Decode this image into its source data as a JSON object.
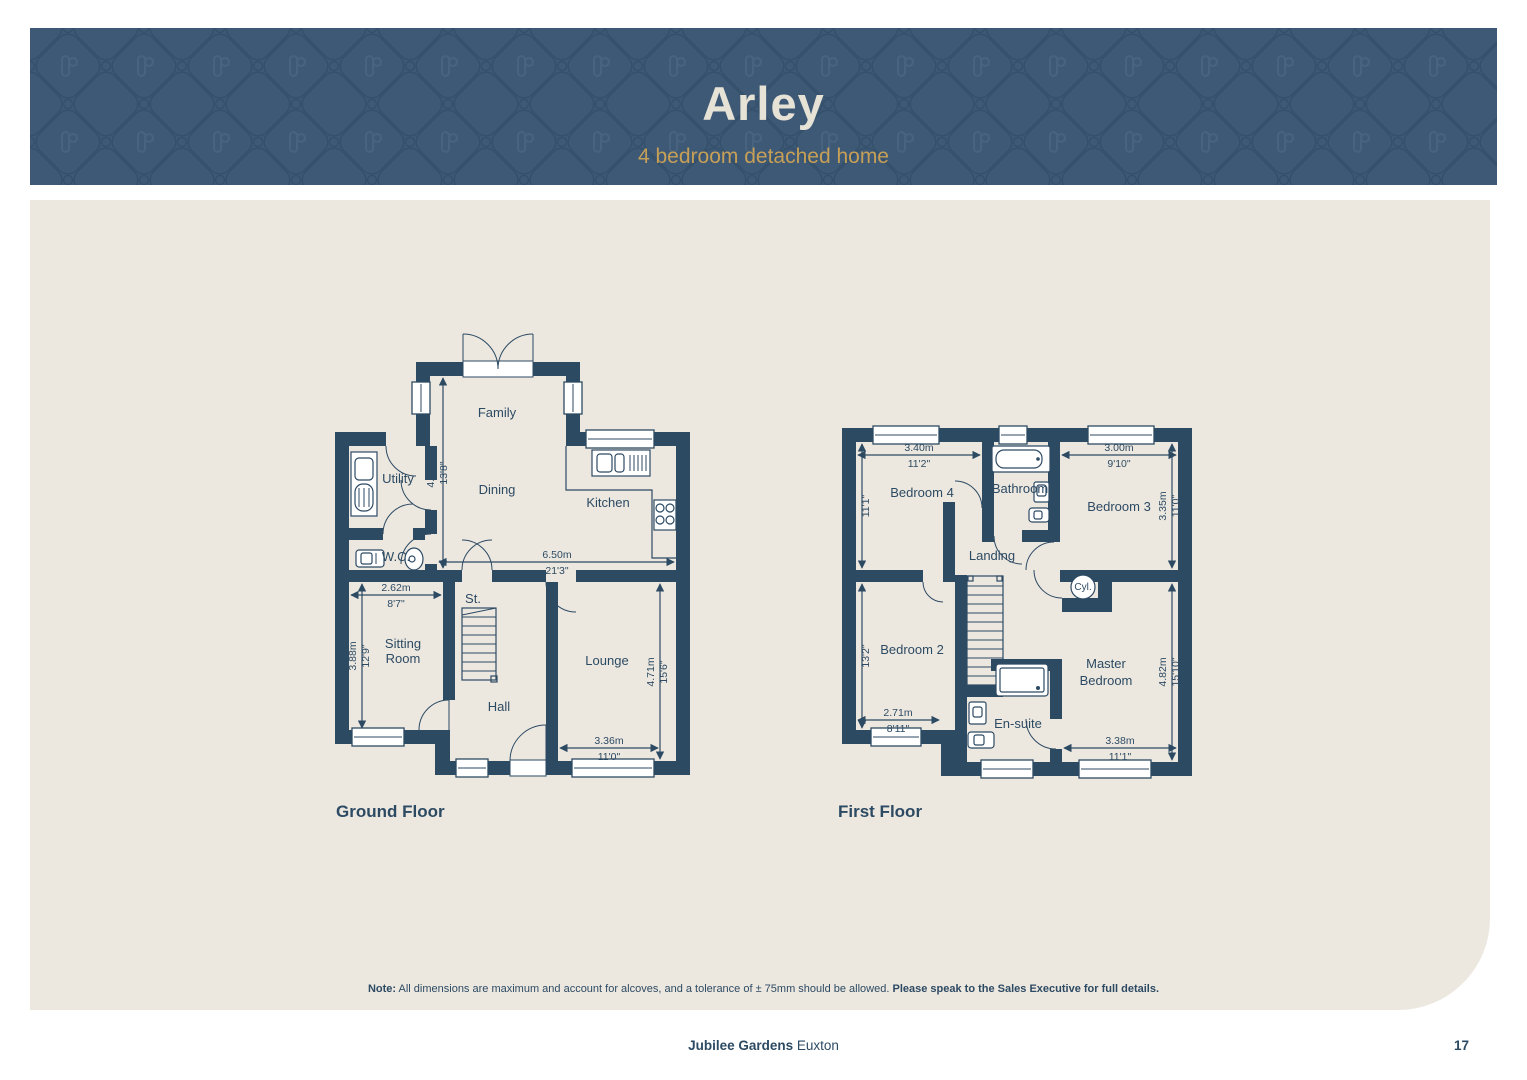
{
  "header": {
    "title": "Arley",
    "subtitle": "4 bedroom detached home"
  },
  "ground_floor": {
    "label": "Ground Floor",
    "rooms": {
      "family": "Family",
      "dining": "Dining",
      "kitchen": "Kitchen",
      "utility": "Utility",
      "wc": "W.C.",
      "store": "St.",
      "sitting1": "Sitting",
      "sitting2": "Room",
      "hall": "Hall",
      "lounge": "Lounge"
    },
    "dims": {
      "family_depth": {
        "m": "4.16m",
        "ft": "13'8\""
      },
      "kitchen_width": {
        "m": "6.50m",
        "ft": "21'3\""
      },
      "sitting_width": {
        "m": "2.62m",
        "ft": "8'7\""
      },
      "sitting_depth": {
        "m": "3.88m",
        "ft": "12'9\""
      },
      "lounge_depth": {
        "m": "4.71m",
        "ft": "15'6\""
      },
      "lounge_width": {
        "m": "3.36m",
        "ft": "11'0\""
      }
    }
  },
  "first_floor": {
    "label": "First Floor",
    "rooms": {
      "bedroom4": "Bedroom 4",
      "bathroom": "Bathroom",
      "bedroom3": "Bedroom 3",
      "landing": "Landing",
      "cyl": "Cyl.",
      "bedroom2": "Bedroom 2",
      "ensuite": "En-suite",
      "master1": "Master",
      "master2": "Bedroom"
    },
    "dims": {
      "bedroom4_width": {
        "m": "3.40m",
        "ft": "11'2\""
      },
      "bedroom4_depth": {
        "m": "3.38m",
        "ft": "11'1\""
      },
      "bedroom3_width": {
        "m": "3.00m",
        "ft": "9'10\""
      },
      "bedroom3_depth": {
        "m": "3.35m",
        "ft": "11'0\""
      },
      "bedroom2_depth": {
        "m": "4.01m",
        "ft": "13'2\""
      },
      "bedroom2_width": {
        "m": "2.71m",
        "ft": "8'11\""
      },
      "master_depth": {
        "m": "4.82m",
        "ft": "15'10\""
      },
      "master_width": {
        "m": "3.38m",
        "ft": "11'1\""
      }
    }
  },
  "note": {
    "prefix": "Note:",
    "body": " All dimensions are maximum and account for alcoves, and a tolerance of ± 75mm should be allowed. ",
    "emphasis": "Please speak to the Sales Executive for full details."
  },
  "footer": {
    "development": "Jubilee Gardens",
    "location": "Euxton",
    "page_number": "17"
  },
  "colors": {
    "wall_navy": "#2D4A63",
    "header_navy": "#3D5976",
    "pattern_line": "#35506B",
    "gold": "#C79F56",
    "cream": "#E7E2D6",
    "beige": "#ECE8E0"
  }
}
